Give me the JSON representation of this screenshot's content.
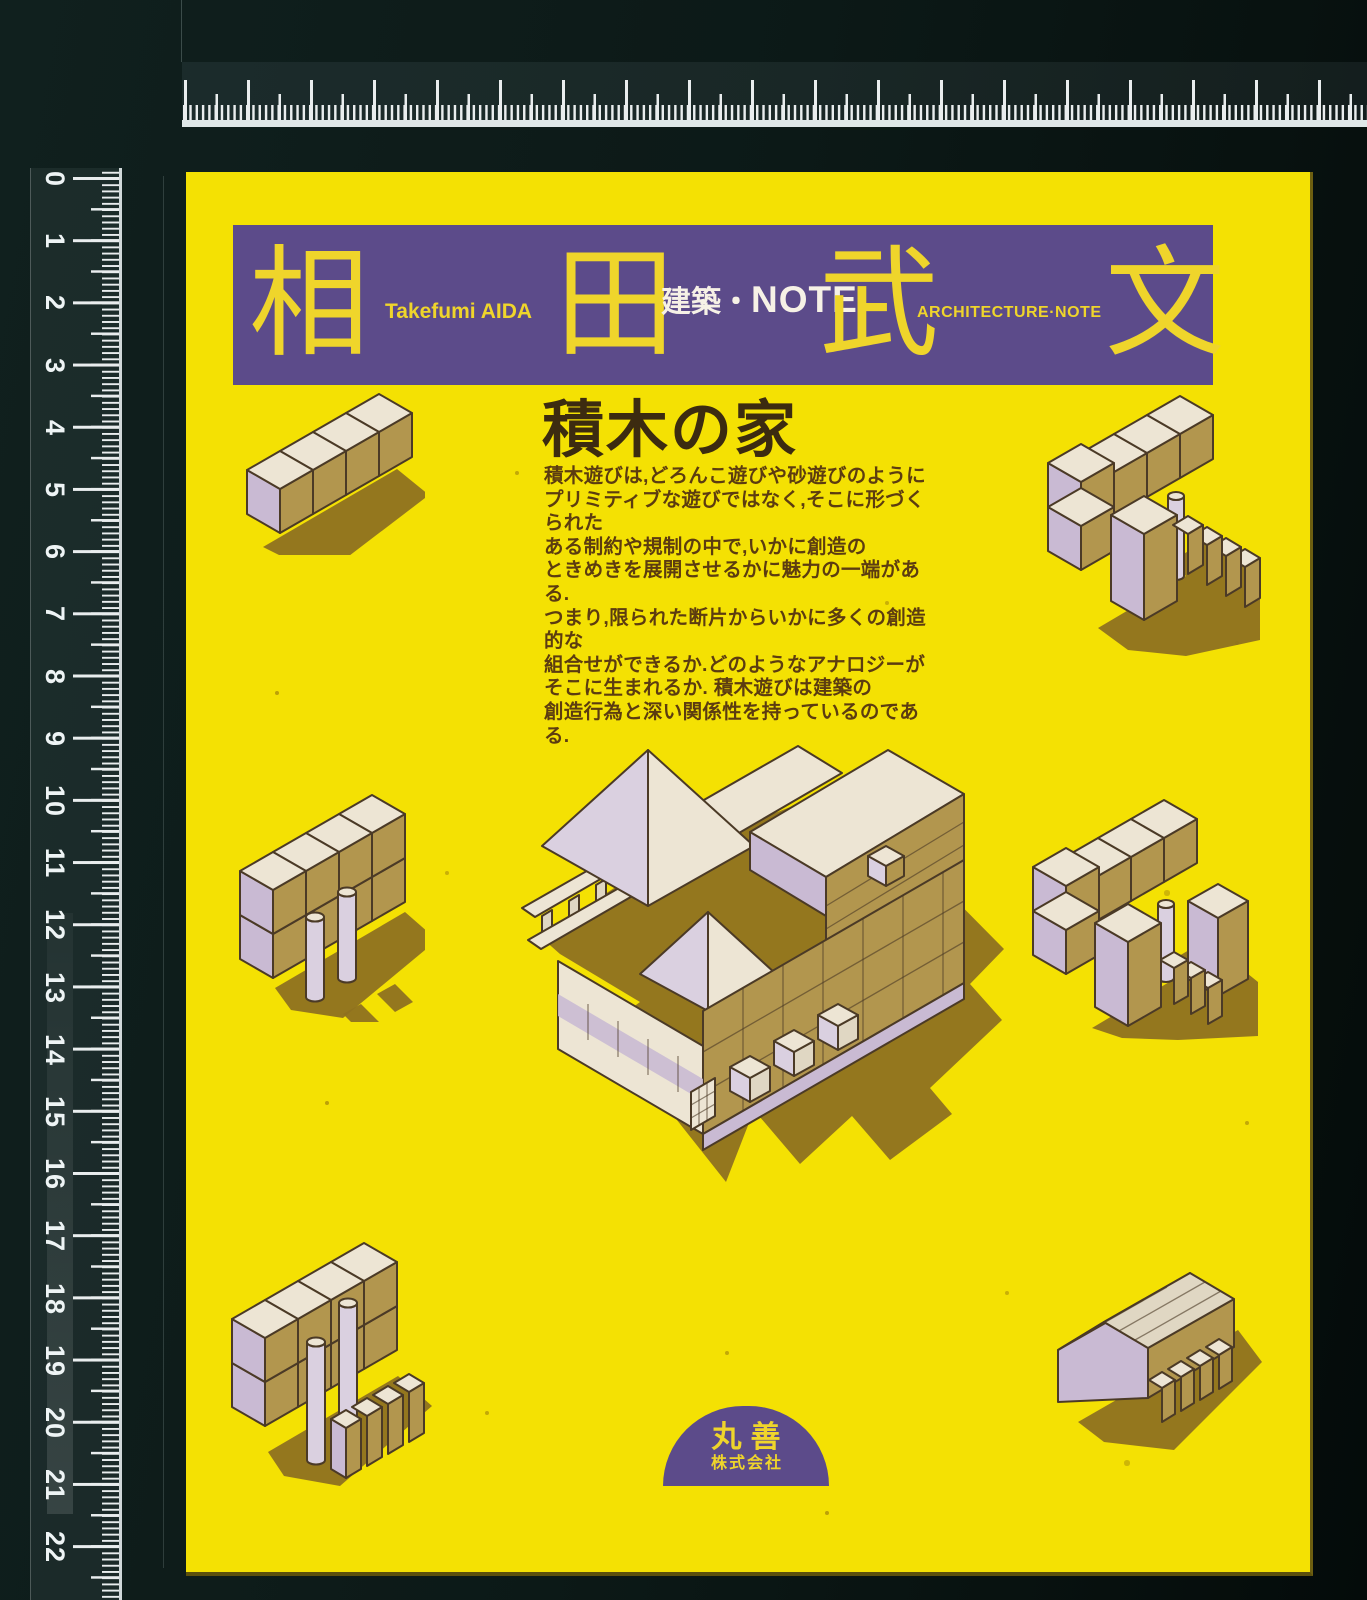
{
  "colors": {
    "bg": "#0C1716",
    "paper": "#F4E103",
    "purple": "#5C4B8A",
    "kanjiYellow": "#EFD52B",
    "bannerWhite": "#F6F1E6",
    "titleBrown": "#3C2B10",
    "bodyBrown": "#5C3C10",
    "cream": "#EDE5D4",
    "cream2": "#E0D7C3",
    "tan": "#B2964E",
    "lav": "#C9BAD3",
    "lavLight": "#DAD0E0",
    "shadow": "#8E7120",
    "line": "#4B3A26",
    "tick": "#E9EDEE"
  },
  "rulers": {
    "left": {
      "numbers": [
        "0",
        "1",
        "2",
        "3",
        "4",
        "5",
        "6",
        "7",
        "8",
        "9",
        "10",
        "11",
        "12",
        "13",
        "14",
        "15",
        "16",
        "17",
        "18",
        "19",
        "20",
        "21",
        "22"
      ]
    }
  },
  "cover": {
    "banner": {
      "kanji": [
        "相",
        "田",
        "武",
        "文"
      ],
      "romaji": "Takefumi AIDA",
      "series_jp": "建築・",
      "series_jp_note": "NOTE",
      "series_en": "ARCHITECTURE·NOTE"
    },
    "title": "積木の家",
    "intro": "積木遊びは,どろんこ遊びや砂遊びのように\nプリミティブな遊びではなく,そこに形づくられた\nある制約や規制の中で,いかに創造の\nときめきを展開させるかに魅力の一端がある.\nつまり,限られた断片からいかに多くの創造的な\n組合せができるか.どのようなアナロジーが\nそこに生まれるか. 積木遊びは建築の\n創造行為と深い関係性を持っているのである.",
    "publisher": {
      "name": "丸善",
      "type": "株式会社"
    }
  }
}
